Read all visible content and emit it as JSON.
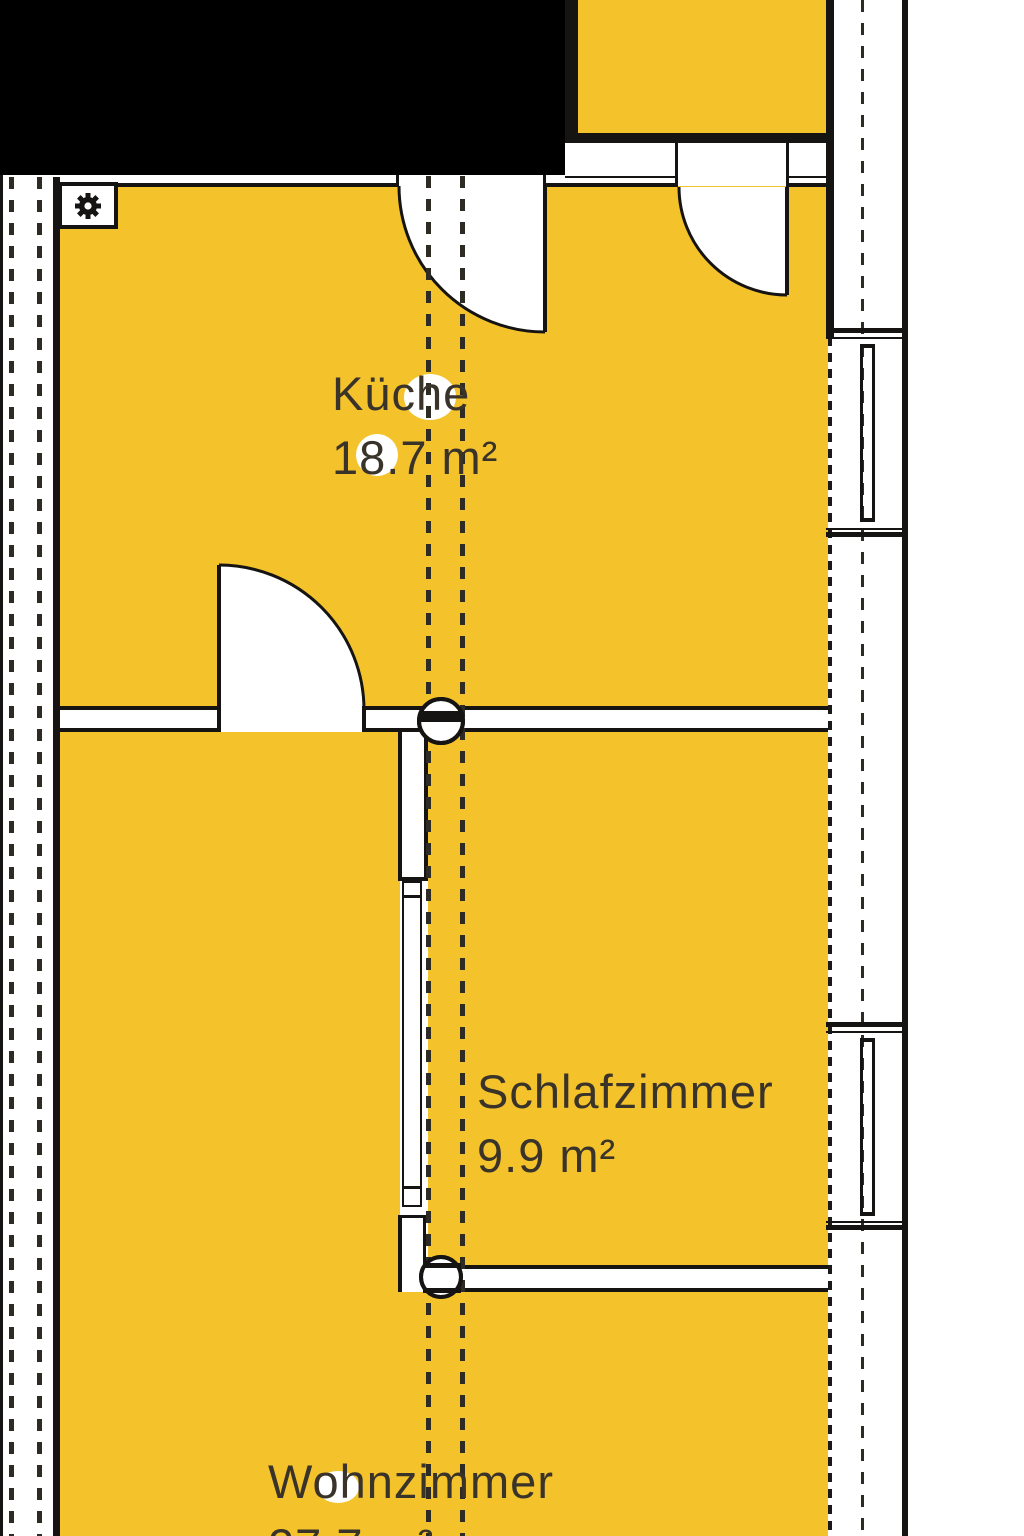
{
  "plan_title": "Wohnungsgrundriss",
  "rooms": [
    {
      "name": "Küche",
      "area": "18.7 m²"
    },
    {
      "name": "Schlafzimmer",
      "area": "9.9 m²"
    },
    {
      "name": "Wohnzimmer",
      "area": "27.7 m²"
    }
  ],
  "icons": {
    "corner_box_symbol": "gear-icon",
    "wall_junction_symbol": "pipe-circle-icon",
    "door_symbol": "door-swing-icon",
    "window_symbol": "window-icon"
  },
  "colors": {
    "room_fill": "#F4C32B",
    "wall": "#151412",
    "section_dash": "#2E2A24",
    "label_text": "#3A3329",
    "redaction": "#000000",
    "paper": "#FFFFFF"
  }
}
